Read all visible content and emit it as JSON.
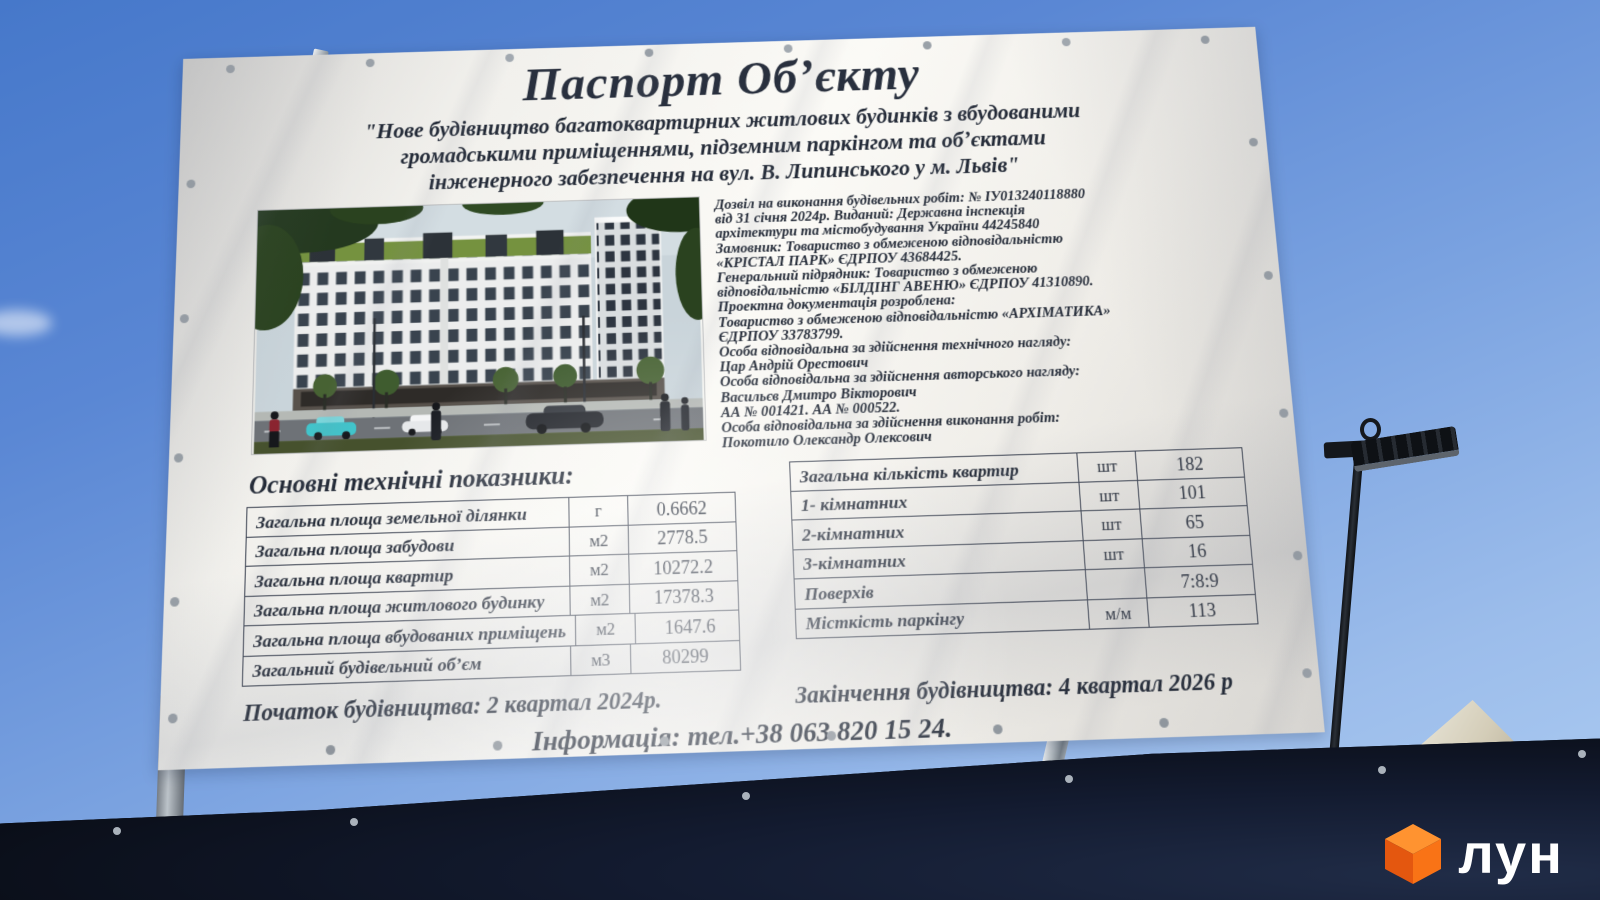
{
  "billboard": {
    "title": "Паспорт Обʼєкту",
    "subtitle_lines": [
      "\"Нове будівництво багатоквартирних житлових будинків з вбудованими",
      "громадськими приміщеннями, підземним паркінгом та обʼєктами",
      "інженерного забезпечення на вул.  В. Липинського  у  м. Львів\""
    ],
    "permit_lines": [
      "Дозвіл на виконання будівельних робіт: № ІУ013240118880",
      "від 31 січня 2024р. Виданий: Державна інспекція",
      "архітектури та  містобудування України 44245840",
      "Замовник: Товариство з обмеженою відповідальністю",
      "«КРІСТАЛ  ПАРК» ЄДРПОУ 43684425.",
      "Генеральний підрядник: Товариство з обмеженою",
      "відповідальністю «БІЛДІНГ  АВЕНЮ» ЄДРПОУ 41310890.",
      "Проектна документація розроблена:",
      "Товариство з обмеженою відповідальністю «АРХІМАТИКА»",
      "ЄДРПОУ 33783799.",
      "Особа відповідальна за здійснення технічного нагляду:",
      "Цар Андрій Орестович",
      "Особа відповідальна за здійснення авторського нагляду:",
      "Васильєв Дмитро Вікторович",
      "АА № 001421. АА № 000522.",
      "Особа відповідальна за здійснення виконання робіт:",
      "Покотило Олександр Олексович"
    ],
    "tech_heading": "Основні технічні показники:",
    "left_table": {
      "rows": [
        {
          "label": "Загальна площа земельної ділянки",
          "unit": "г",
          "value": "0.6662"
        },
        {
          "label": "Загальна площа забудови",
          "unit": "м2",
          "value": "2778.5"
        },
        {
          "label": "Загальна площа квартир",
          "unit": "м2",
          "value": "10272.2"
        },
        {
          "label": "Загальна площа житлового будинку",
          "unit": "м2",
          "value": "17378.3"
        },
        {
          "label": "Загальна площа вбудованих приміщень",
          "unit": "м2",
          "value": "1647.6"
        },
        {
          "label": "Загальний будівельний обʼєм",
          "unit": "м3",
          "value": "80299"
        }
      ]
    },
    "right_table": {
      "rows": [
        {
          "label": "Загальна кількість квартир",
          "unit": "шт",
          "value": "182"
        },
        {
          "label": "1- кімнатних",
          "unit": "шт",
          "value": "101"
        },
        {
          "label": "2-кімнатних",
          "unit": "шт",
          "value": "65"
        },
        {
          "label": "3-кімнатних",
          "unit": "шт",
          "value": "16"
        },
        {
          "label": "Поверхів",
          "unit": "",
          "value": "7:8:9"
        },
        {
          "label": "Місткість паркінгу",
          "unit": "м/м",
          "value": "113"
        }
      ]
    },
    "start_date": "Початок будівництва: 2 квартал 2024р.",
    "end_date": "Закінчення будівництва:  4  квартал 2026 р",
    "info_line": "Інформація: тел.+38 063 820 15 24."
  },
  "watermark": {
    "text": "лун",
    "cube_color": "#f97316"
  },
  "colors": {
    "sky_top": "#4678ca",
    "sky_bottom": "#aecdf2",
    "banner": "#f1f0ec",
    "ink": "#242b38",
    "fence": "#0c1018",
    "logo_orange": "#f97316"
  }
}
